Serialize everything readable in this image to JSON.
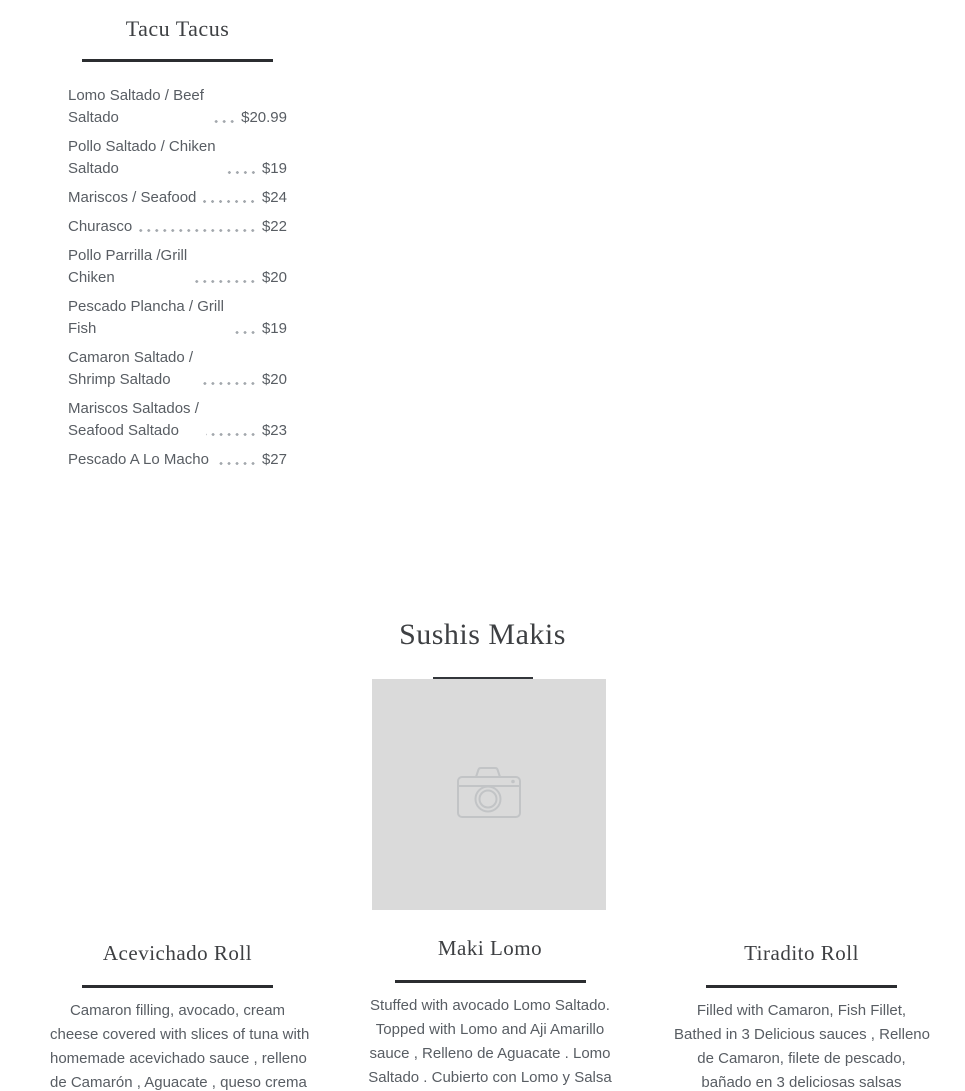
{
  "colors": {
    "background": "#ffffff",
    "heading_text": "#3e4043",
    "body_text": "#585d63",
    "divider": "#2b2d30",
    "dot_leader": "#a3a8ad",
    "placeholder_bg": "#dadada",
    "placeholder_icon": "#c2c4c6"
  },
  "tacu_section": {
    "title": "Tacu Tacus",
    "items": [
      {
        "name_lines": [
          "Lomo Saltado / Beef",
          "Saltado"
        ],
        "price": "$20.99"
      },
      {
        "name_lines": [
          "Pollo Saltado / Chiken",
          "Saltado"
        ],
        "price": "$19"
      },
      {
        "name_lines": [
          "Mariscos / Seafood",
          ""
        ],
        "price": "$24"
      },
      {
        "name_lines": [
          "Churasco",
          ""
        ],
        "price": "$22"
      },
      {
        "name_lines": [
          "Pollo Parrilla /Grill",
          "Chiken"
        ],
        "price": "$20"
      },
      {
        "name_lines": [
          "Pescado Plancha / Grill",
          "Fish"
        ],
        "price": "$19"
      },
      {
        "name_lines": [
          "Camaron Saltado /",
          "Shrimp Saltado"
        ],
        "price": "$20"
      },
      {
        "name_lines": [
          "Mariscos Saltados /",
          "Seafood Saltado"
        ],
        "price": "$23"
      },
      {
        "name_lines": [
          "Pescado A Lo Macho",
          ""
        ],
        "price": "$27"
      }
    ]
  },
  "sushis_section": {
    "title": "Sushis Makis",
    "image_placeholder_icon": "camera-icon"
  },
  "columns": [
    {
      "title": "Acevichado Roll",
      "lines": [
        "Camaron filling, avocado, cream",
        "cheese covered with slices of tuna with",
        "homemade acevichado sauce , relleno",
        "de Camarón , Aguacate , queso crema"
      ]
    },
    {
      "title": "Maki Lomo",
      "lines": [
        "Stuffed with avocado Lomo Saltado.",
        "Topped with Lomo and Aji Amarillo",
        "sauce , Relleno de Aguacate . Lomo",
        "Saltado . Cubierto con Lomo y Salsa"
      ]
    },
    {
      "title": "Tiradito Roll",
      "lines": [
        "Filled with Camaron, Fish Fillet,",
        "Bathed in 3 Delicious sauces , Relleno",
        "de Camaron, filete de pescado,",
        "bañado en 3 deliciosas salsas"
      ]
    }
  ]
}
